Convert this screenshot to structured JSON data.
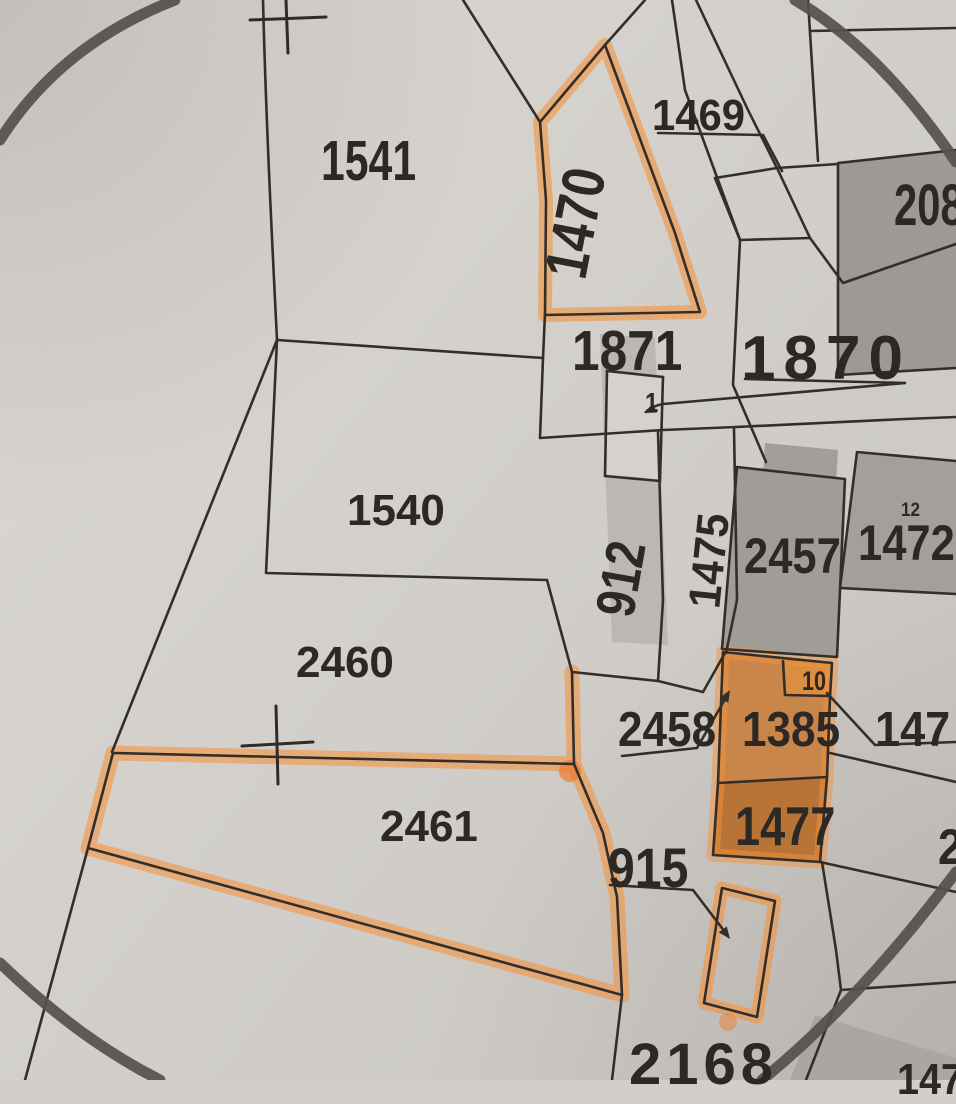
{
  "map": {
    "title": "Cadastral parcel map photo with orange-highlighted parcels",
    "colors": {
      "paper": "#d2cfcb",
      "ink": "#332e2a",
      "building_fill": "#a09c98",
      "shaded_strip": "#b5b1ad",
      "highlighter": "#f4923a",
      "highlight_fill_upper": "#c9772f",
      "highlight_fill_lower": "#b5661f",
      "highlight_fill_box": "#dd8f3f",
      "circle_stroke": "#56514c"
    },
    "highlighted_parcels": [
      "1470",
      "2461",
      "1385",
      "1477",
      "strip near 915"
    ],
    "symbols": [
      "survey-cross top",
      "survey-cross in 2461",
      "large circle mark",
      "leader arrows"
    ],
    "labels": {
      "l1541": "1541",
      "l1469": "1469",
      "l1470": "1470",
      "l208": "208",
      "l1871": "1871",
      "l1870": "1870",
      "lhouse1": "1",
      "l1540": "1540",
      "l912": "912",
      "l1475": "1475",
      "l2457": "2457",
      "l12": "12",
      "l1472": "1472",
      "l2460": "2460",
      "l2458": "2458",
      "l1385": "1385",
      "l10": "10",
      "l147": "147",
      "l1477": "1477",
      "l2461": "2461",
      "l915": "915",
      "l2168": "2168",
      "l2partial": "2",
      "l1478partial": "1478"
    }
  }
}
